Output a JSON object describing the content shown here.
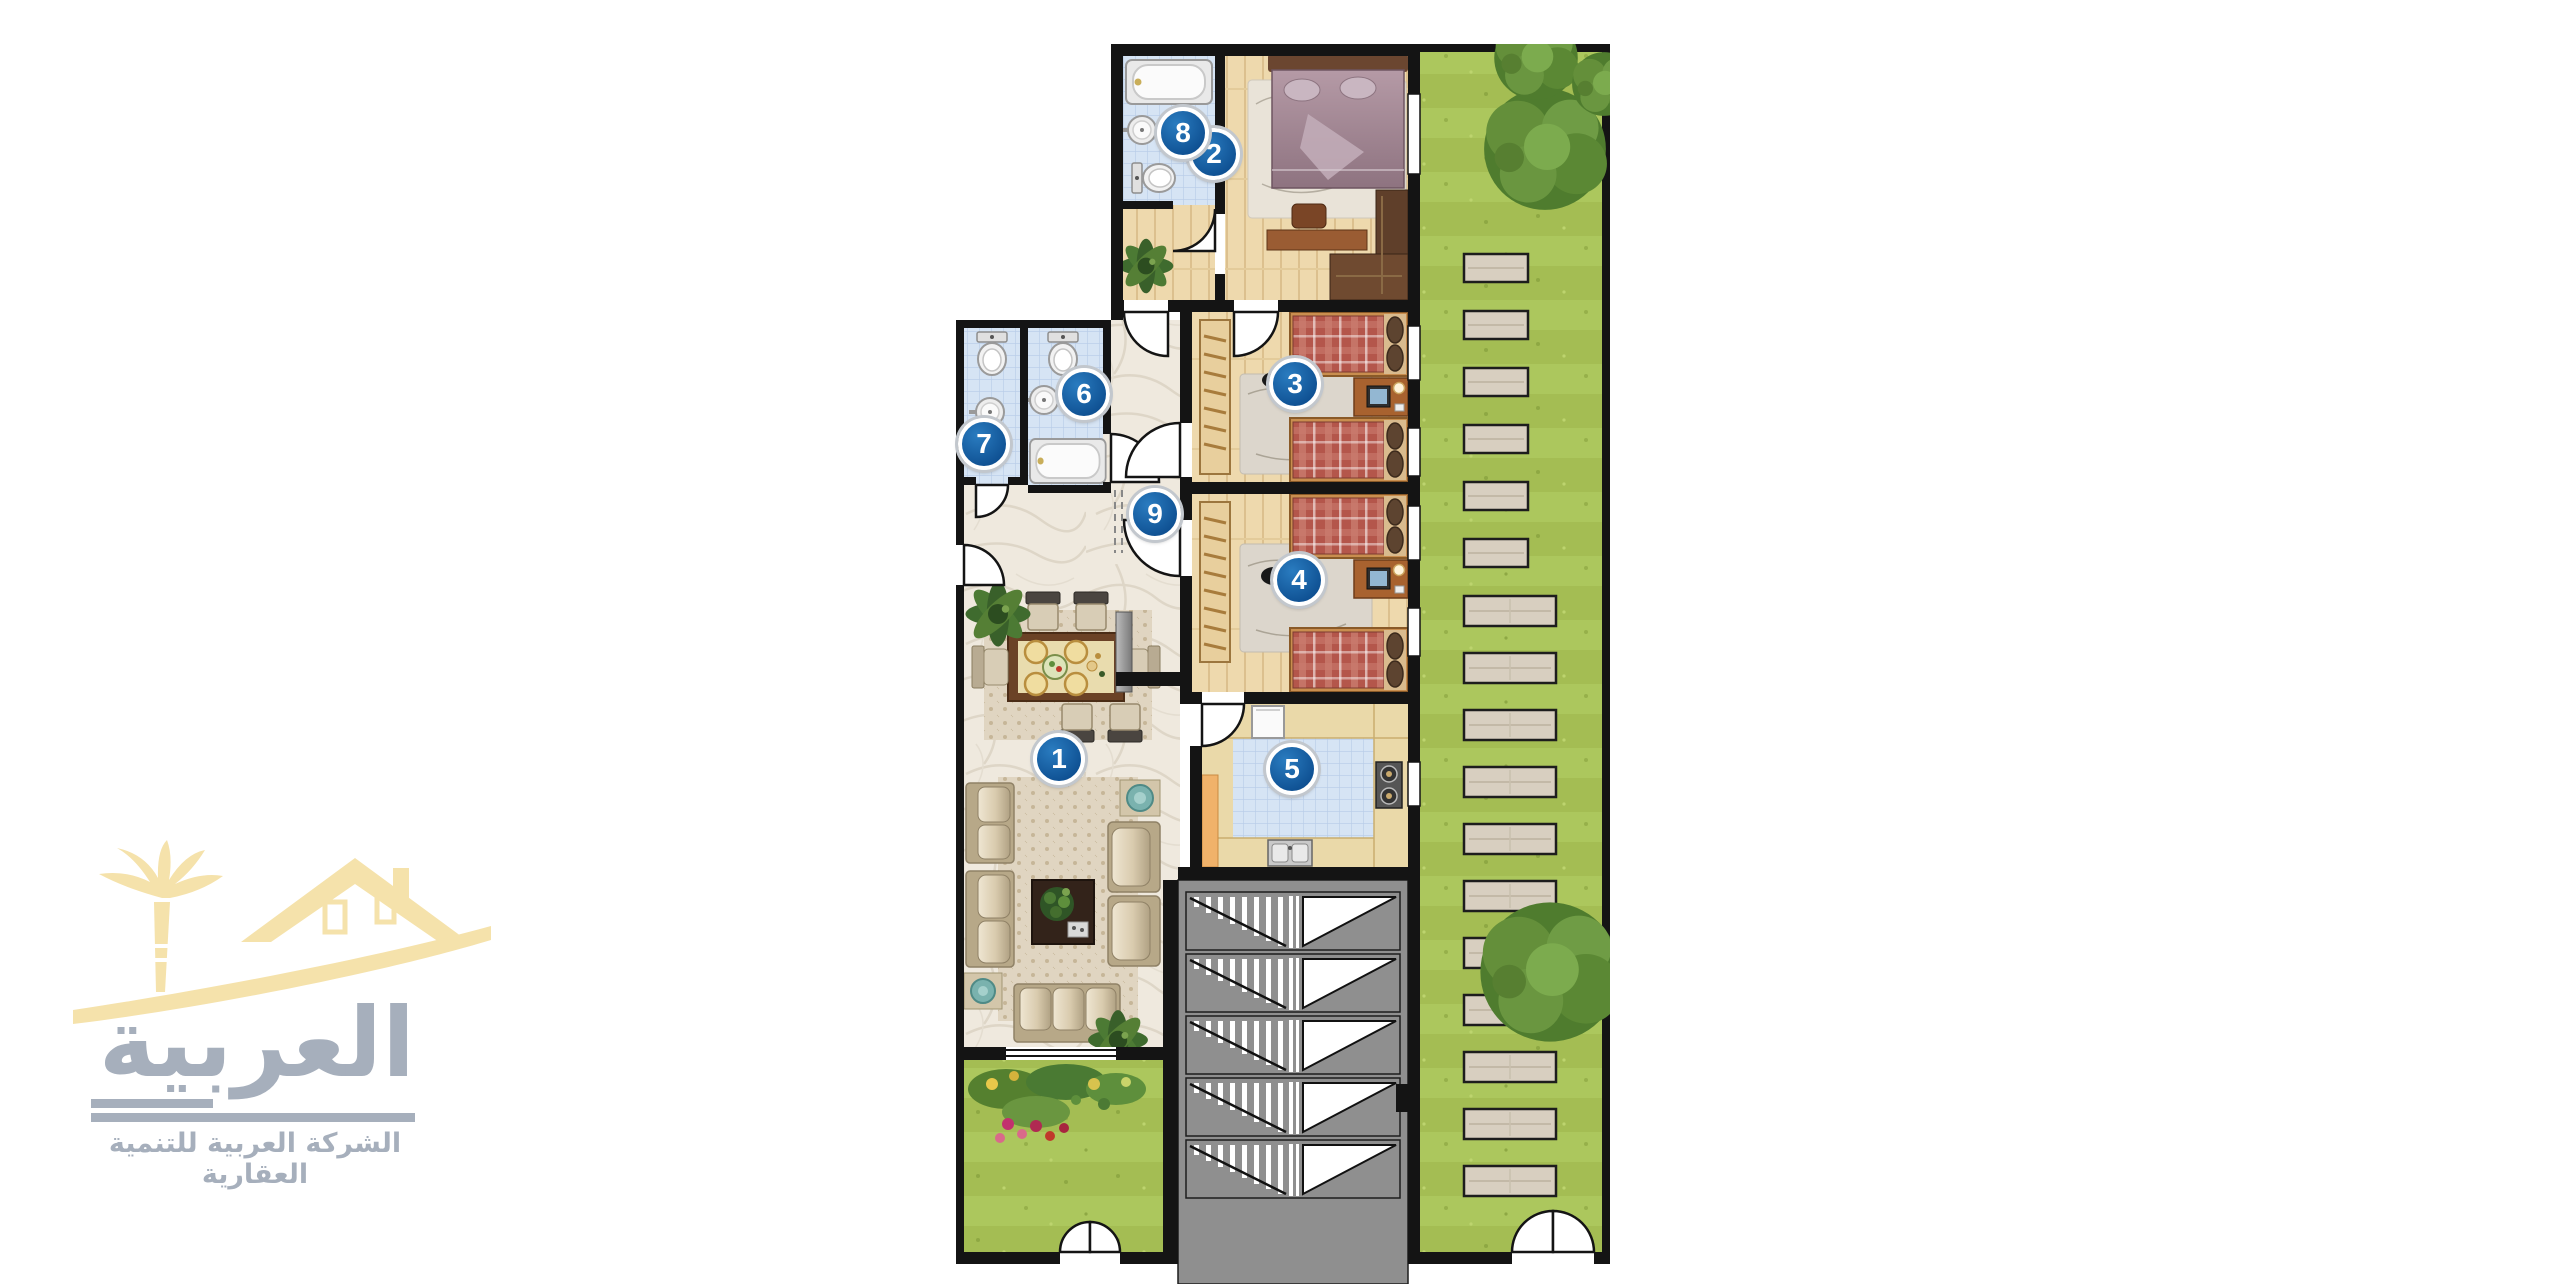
{
  "page": {
    "background": "#ffffff"
  },
  "logo": {
    "brand": "العربية",
    "tagline": "الشركة العربية للتنمية العقارية",
    "emblem_color": "#f5e2ab",
    "text_color": "#a6afbc",
    "emblem_icons": [
      "palm-tree-icon",
      "house-roof-icon",
      "swoosh-icon"
    ]
  },
  "plan": {
    "badges": [
      {
        "number": "1",
        "room": "living-dining-room"
      },
      {
        "number": "2",
        "room": "master-bedroom"
      },
      {
        "number": "3",
        "room": "bedroom"
      },
      {
        "number": "4",
        "room": "bedroom"
      },
      {
        "number": "5",
        "room": "kitchen"
      },
      {
        "number": "6",
        "room": "bathroom"
      },
      {
        "number": "7",
        "room": "toilet"
      },
      {
        "number": "8",
        "room": "bathroom"
      },
      {
        "number": "9",
        "room": "hallway"
      }
    ],
    "fixtures": [
      "bathtub",
      "toilet",
      "washbasin",
      "double-bed",
      "twin-bed",
      "wardrobe",
      "desk-computer",
      "dining-table",
      "sofa",
      "armchair",
      "coffee-table",
      "refrigerator",
      "stove",
      "kitchen-sink",
      "staircase",
      "stepping-stones",
      "tree",
      "flower-bed",
      "door-arc",
      "plant",
      "elevator"
    ],
    "colors": {
      "wall": "#141414",
      "badge_fill": "#10549a",
      "badge_ring": "#ffffff",
      "grass": "#a6c157",
      "marble": "#efe9de",
      "tile_blue": "#d6e4f4",
      "wood": "#eed9ad",
      "stair_gray": "#8f8f8f",
      "bed_red": "#b4564b",
      "bed_purple": "#a18795",
      "stone": "#d8cfc0",
      "counter": "#ead9a9",
      "carpet": "#e0d5c1",
      "sofa": "#d6c9b0"
    }
  }
}
